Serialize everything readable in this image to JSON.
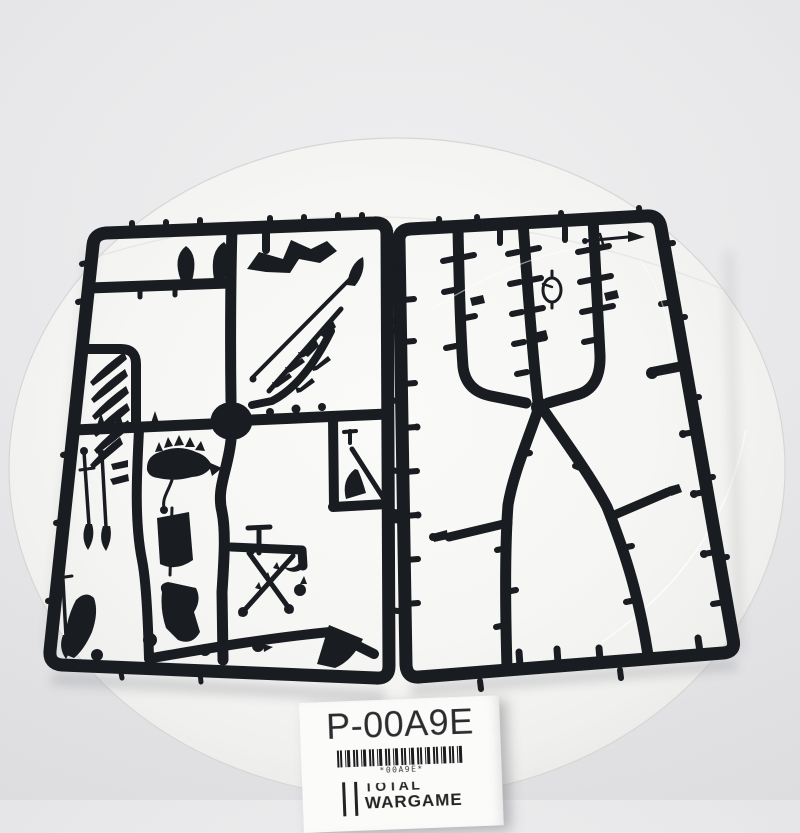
{
  "colors": {
    "background": "#e4e4e6",
    "plate": "#f8f8f6",
    "sprue": "#191c21",
    "label_bg": "#fbfbfa",
    "label_text": "#2c2c30",
    "barcode": "#1d1d1f"
  },
  "label": {
    "part_code": "P-00A9E",
    "barcode_caption": "*00A9E*",
    "brand_word_top": "TOTAL",
    "brand_word_bottom": "WARGAME"
  }
}
